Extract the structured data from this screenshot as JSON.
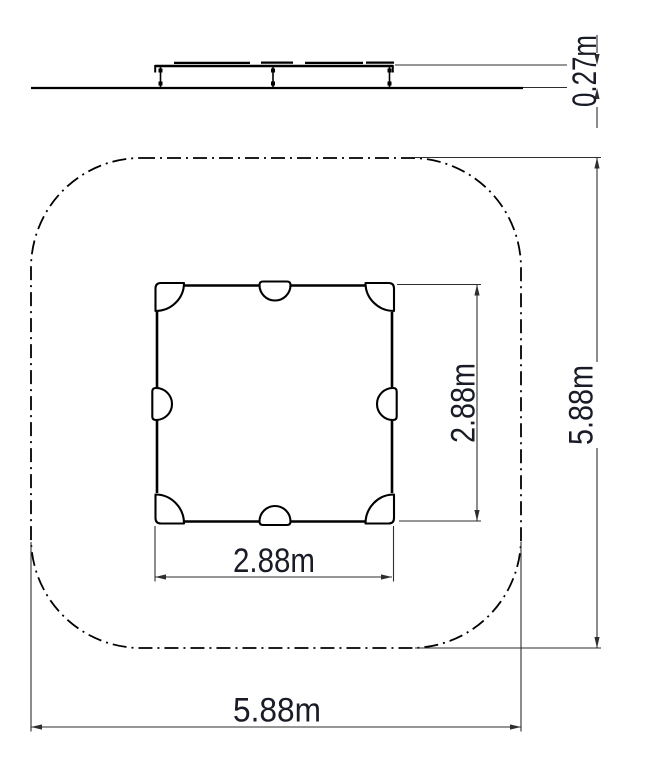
{
  "labels": {
    "elevation_height": "0.27m",
    "inner_width": "2.88m",
    "inner_height": "2.88m",
    "outer_width": "5.88m",
    "outer_height": "5.88m"
  },
  "colors": {
    "line": "#000000",
    "dimension": "#2e2e2e",
    "text": "#191c27",
    "background": "#ffffff"
  }
}
